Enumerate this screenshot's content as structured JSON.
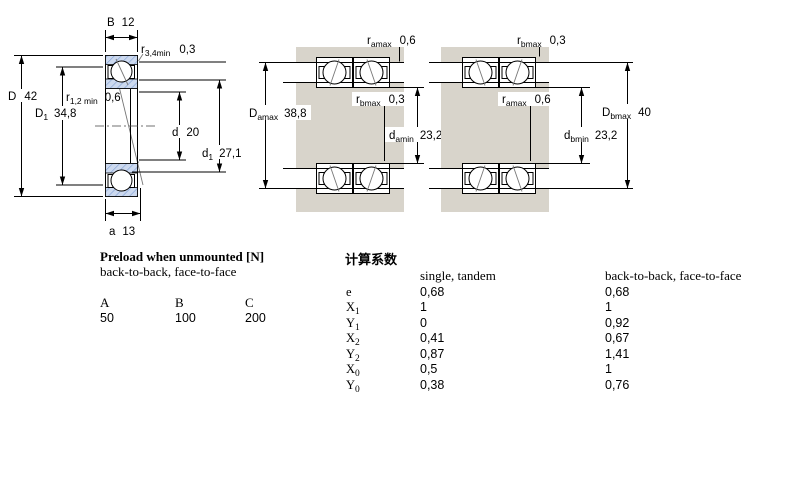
{
  "drawing": {
    "left": {
      "B": {
        "sym": "B",
        "val": "12"
      },
      "r34": {
        "sym": "r",
        "sub": "3,4min",
        "val": "0,3"
      },
      "D": {
        "sym": "D",
        "val": "42"
      },
      "D1": {
        "sym": "D",
        "sub": "1",
        "val": "34,8"
      },
      "r12": {
        "sym": "r",
        "sub": "1,2 min",
        "val": "0,6"
      },
      "d": {
        "sym": "d",
        "val": "20"
      },
      "d1": {
        "sym": "d",
        "sub": "1",
        "val": "27,1"
      },
      "a": {
        "sym": "a",
        "val": "13"
      }
    },
    "middle": {
      "ramax": {
        "sym": "r",
        "sub": "amax",
        "val": "0,6"
      },
      "rbmax": {
        "sym": "r",
        "sub": "bmax",
        "val": "0,3"
      },
      "Damax": {
        "sym": "D",
        "sub": "amax",
        "val": "38,8"
      },
      "damin": {
        "sym": "d",
        "sub": "amin",
        "val": "23,2"
      }
    },
    "right": {
      "rbmax": {
        "sym": "r",
        "sub": "bmax",
        "val": "0,3"
      },
      "ramax": {
        "sym": "r",
        "sub": "amax",
        "val": "0,6"
      },
      "Dbmax": {
        "sym": "D",
        "sub": "bmax",
        "val": "40"
      },
      "dbmin": {
        "sym": "d",
        "sub": "bmin",
        "val": "23,2"
      }
    },
    "colors": {
      "housing_gray": "#d8d4cb",
      "ring_fill": "#ccd9ef",
      "ring_hatch": "#7f9fd4",
      "line": "#000000"
    }
  },
  "preload": {
    "title": "Preload when unmounted [N]",
    "subtitle": "back-to-back, face-to-face",
    "headers": [
      "A",
      "B",
      "C"
    ],
    "values": [
      "50",
      "100",
      "200"
    ]
  },
  "factors": {
    "title": "计算系数",
    "col1": "single, tandem",
    "col2": "back-to-back, face-to-face",
    "rows": [
      {
        "sym": "e",
        "sub": "",
        "v1": "0,68",
        "v2": "0,68"
      },
      {
        "sym": "X",
        "sub": "1",
        "v1": "1",
        "v2": "1"
      },
      {
        "sym": "Y",
        "sub": "1",
        "v1": "0",
        "v2": "0,92"
      },
      {
        "sym": "X",
        "sub": "2",
        "v1": "0,41",
        "v2": "0,67"
      },
      {
        "sym": "Y",
        "sub": "2",
        "v1": "0,87",
        "v2": "1,41"
      },
      {
        "sym": "X",
        "sub": "0",
        "v1": "0,5",
        "v2": "1"
      },
      {
        "sym": "Y",
        "sub": "0",
        "v1": "0,38",
        "v2": "0,76"
      }
    ]
  }
}
